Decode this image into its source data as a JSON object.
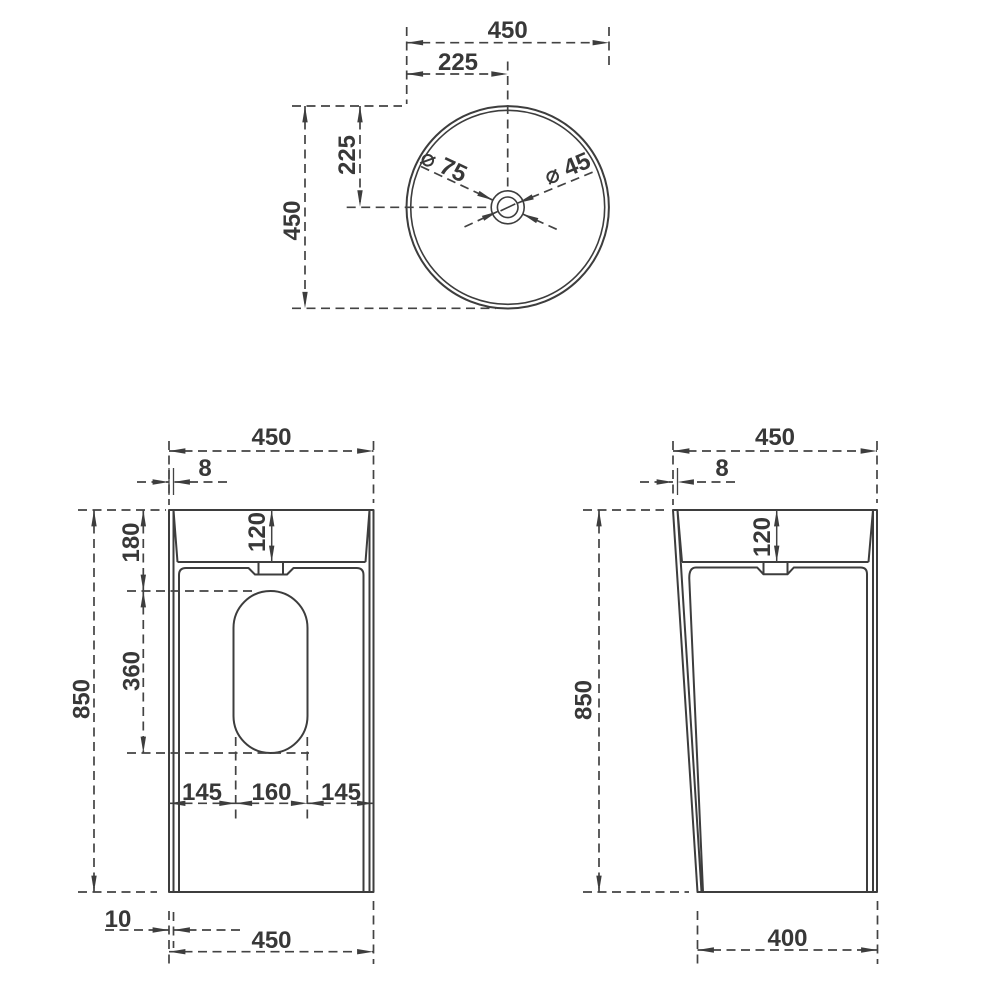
{
  "colors": {
    "line": "#3d3d3d",
    "text": "#383838",
    "background": "#ffffff"
  },
  "views": {
    "top": {
      "dims": {
        "overall_width": "450",
        "center_offset_h": "225",
        "center_offset_v": "225",
        "overall_depth": "450",
        "drain_outer_dia": "⌀ 75",
        "drain_inner_dia": "⌀ 45"
      }
    },
    "front": {
      "dims": {
        "overall_width": "450",
        "rim_thickness": "8",
        "basin_inner_depth": "120",
        "rim_to_cutout": "180",
        "cutout_height": "360",
        "overall_height": "850",
        "cutout_offset_left": "145",
        "cutout_width": "160",
        "cutout_offset_right": "145",
        "base_inset": "10",
        "base_width": "450"
      }
    },
    "side": {
      "dims": {
        "overall_width": "450",
        "rim_thickness": "8",
        "basin_inner_depth": "120",
        "overall_height": "850",
        "base_depth": "400"
      }
    }
  }
}
